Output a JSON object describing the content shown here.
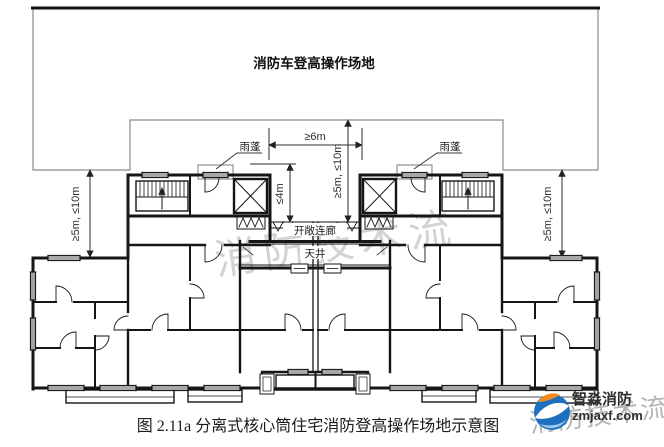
{
  "figure": {
    "site_label": "消防车登高操作场地",
    "dimensions": {
      "gap_between_towers": "≥6m",
      "center_depth": "≥5m, ≤10m",
      "left_depth": "≥5m, ≤10m",
      "right_depth": "≥5m, ≤10m",
      "recess_depth": "≤4m"
    },
    "labels": {
      "canopy_left": "雨蓬",
      "canopy_right": "雨蓬",
      "open_corridor": "开敞连廊",
      "light_well": "天井"
    },
    "caption": "图 2.11a 分离式核心筒住宅消防登高操作场地示意图"
  },
  "watermark": {
    "center_text": "消防技术流",
    "corner_text": "消防技术流"
  },
  "logo": {
    "name": "智淼消防",
    "site": "zmjaxf.com",
    "blue": "#1d6fbf",
    "orange": "#f28a1e"
  },
  "colors": {
    "wall": "#161616",
    "dimension": "#2e2e2e",
    "site_outline": "#8a8a8a",
    "background": "#ffffff"
  }
}
